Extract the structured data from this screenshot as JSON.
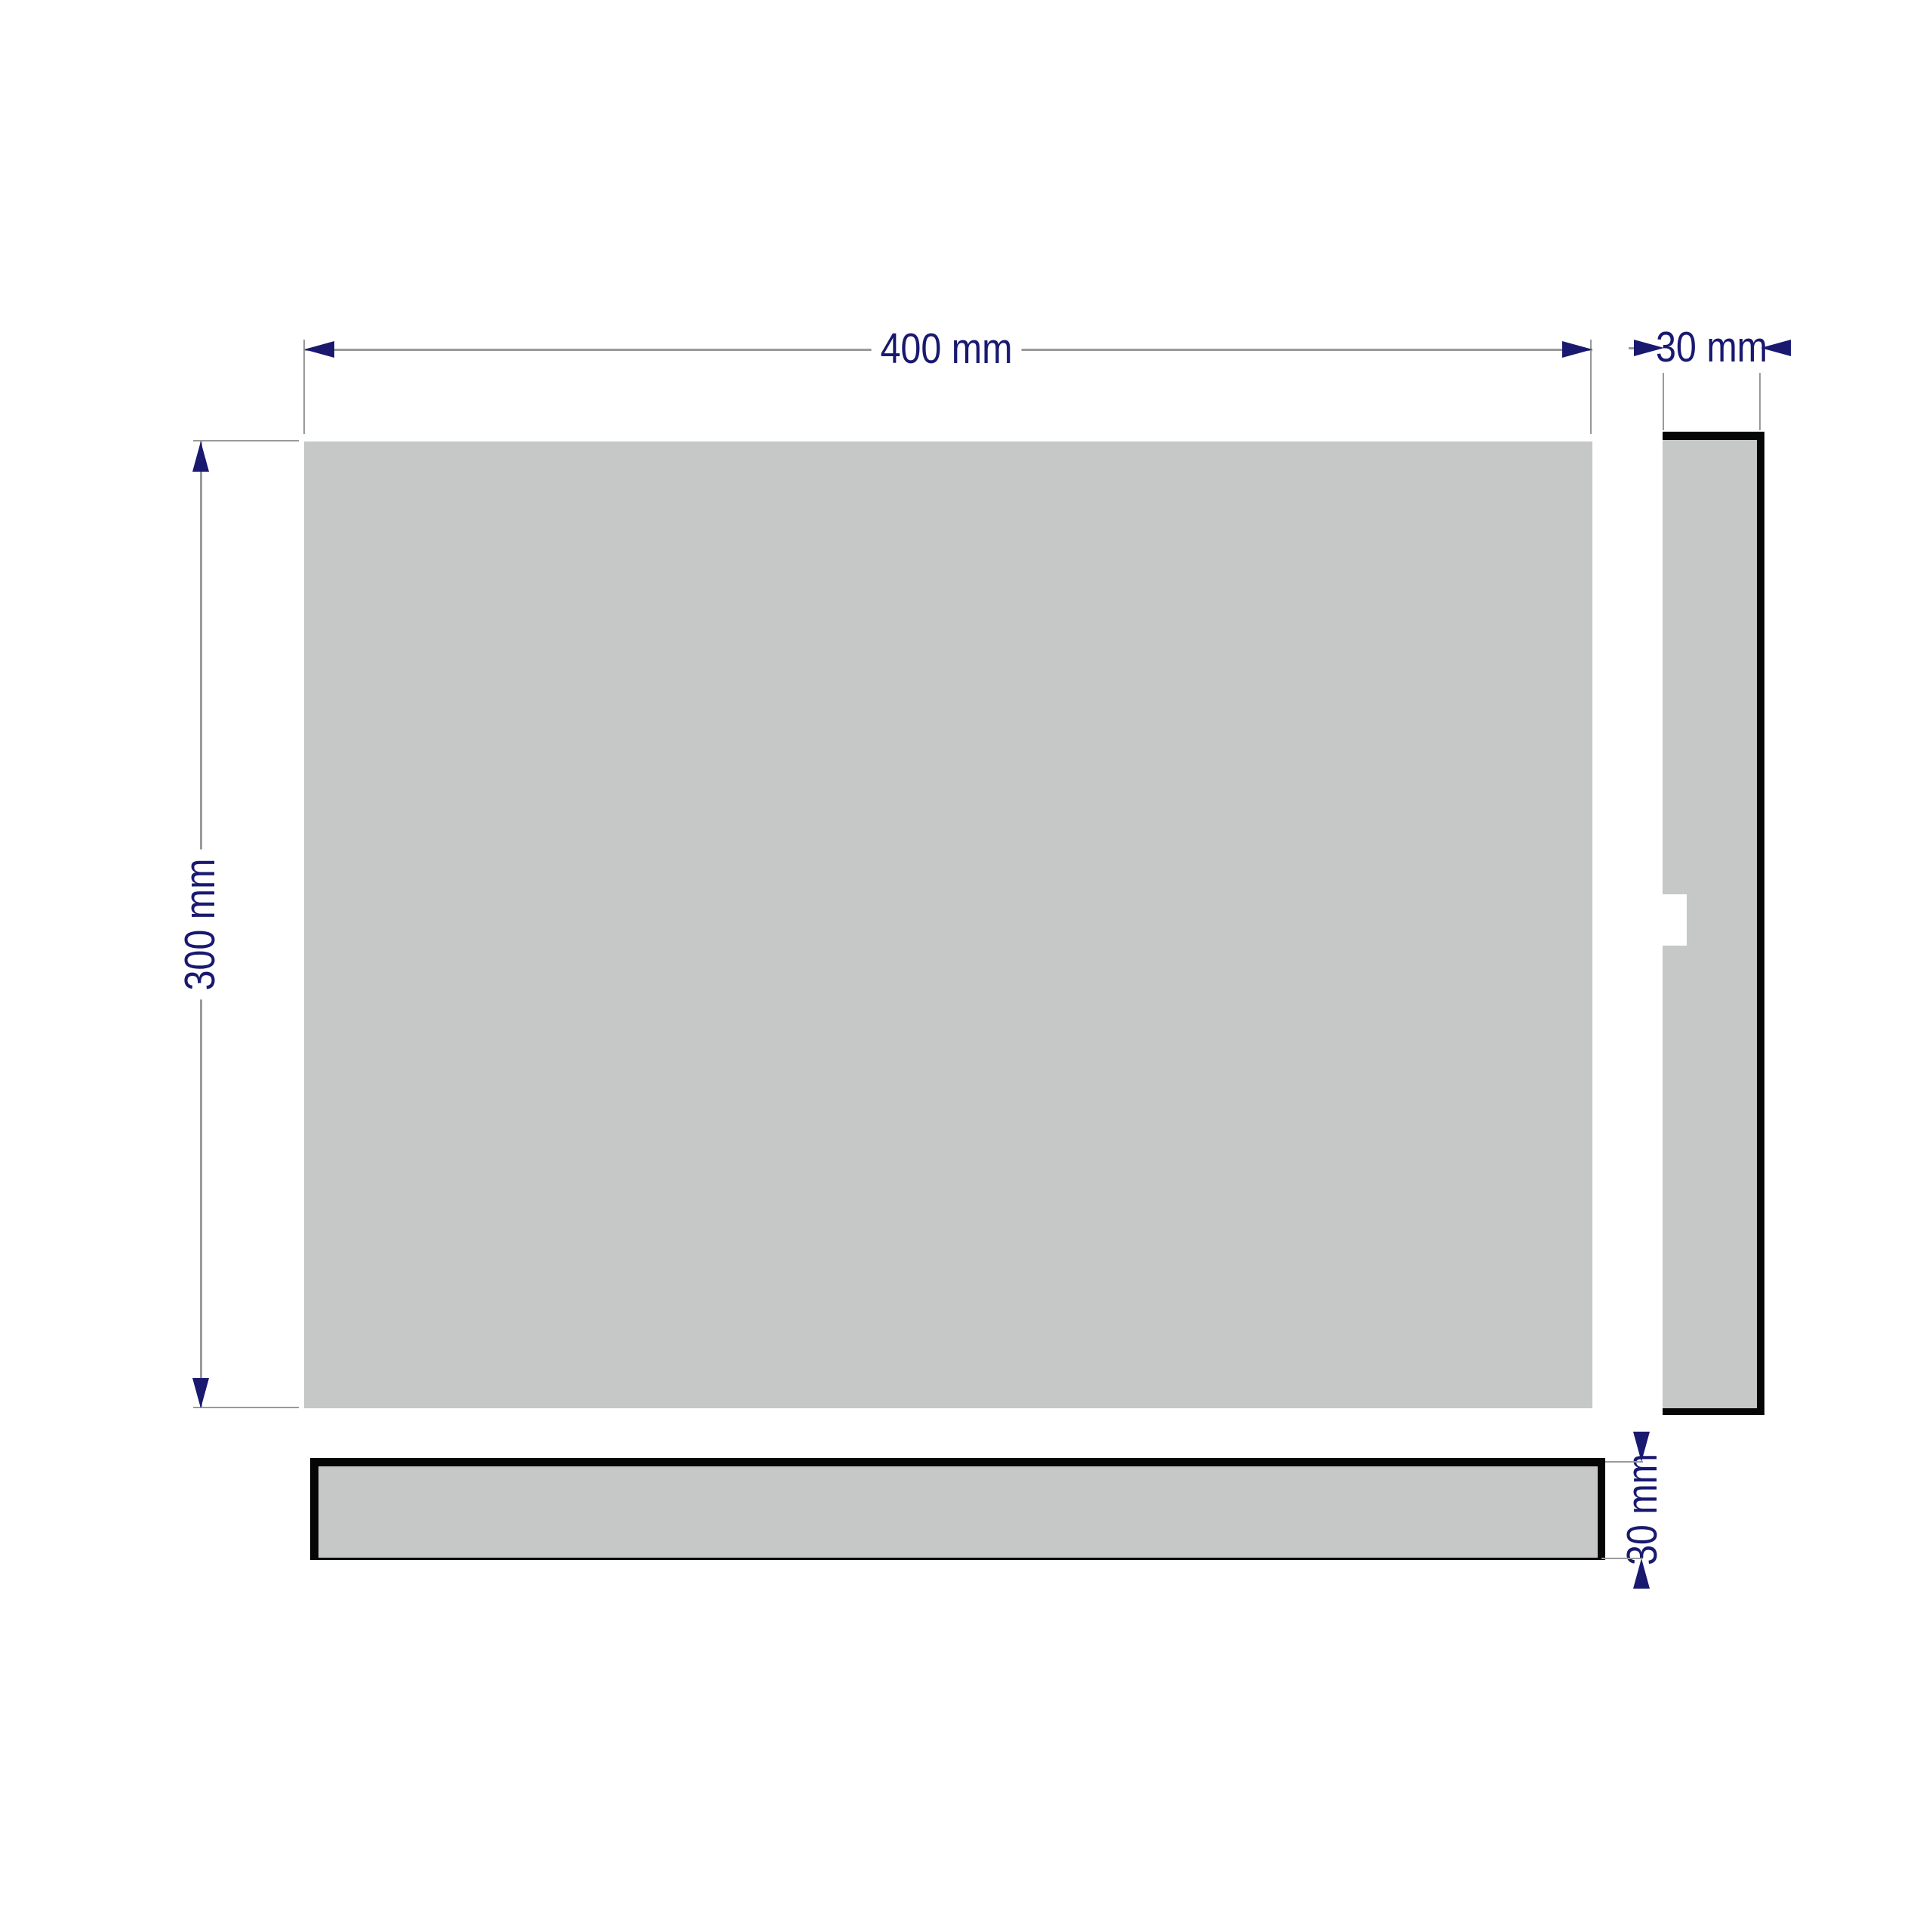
{
  "drawing": {
    "type": "panel-technical-drawing",
    "views": {
      "front": {
        "name": "front panel face",
        "width_mm": 400,
        "height_mm": 300
      },
      "side": {
        "name": "side profile view",
        "depth_mm": 30
      },
      "bottom": {
        "name": "bottom profile view",
        "thickness_mm": 30
      }
    }
  },
  "dimensions": {
    "width": {
      "label": "400 mm",
      "value": 400,
      "unit": "mm"
    },
    "height": {
      "label": "300 mm",
      "value": 300,
      "unit": "mm"
    },
    "side_depth": {
      "label": "30 mm",
      "value": 30,
      "unit": "mm"
    },
    "bottom_thickness": {
      "label": "30 mm",
      "value": 30,
      "unit": "mm"
    }
  },
  "colors": {
    "accent": "#191970",
    "dimline": "#9a9a9a",
    "panel": "#c6c7c7",
    "edge": "#060606",
    "bg": "#ffffff"
  }
}
